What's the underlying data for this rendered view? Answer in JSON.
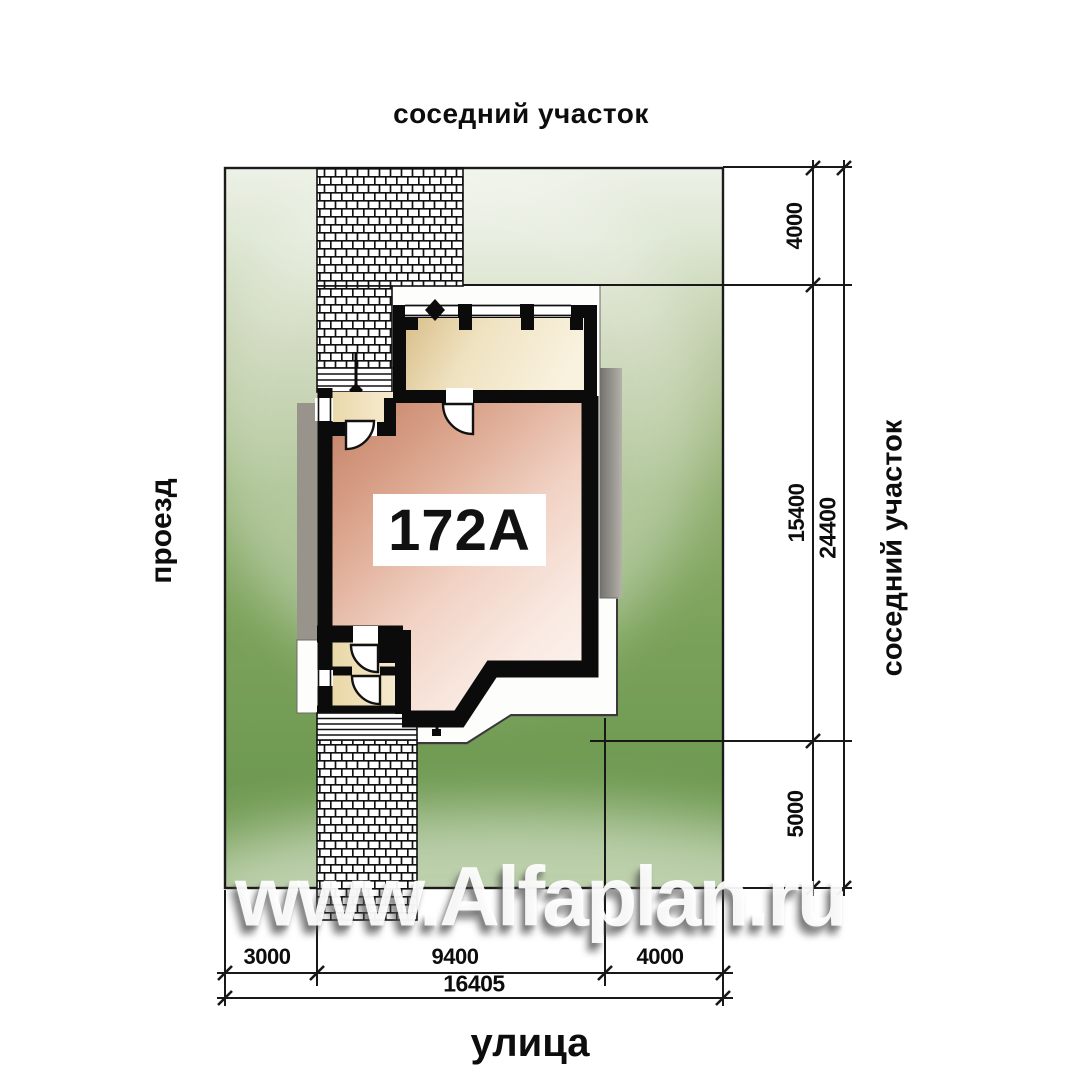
{
  "site_plan": {
    "labels": {
      "top_neighbor": "соседний участок",
      "right_neighbor": "соседний участок",
      "left_passage": "проезд",
      "bottom_street": "улица"
    },
    "house_number": "172A",
    "dimensions": {
      "right": [
        {
          "label": "4000"
        },
        {
          "label": "15400"
        },
        {
          "label": "5000"
        },
        {
          "label": "24400"
        }
      ],
      "bottom": [
        {
          "label": "3000"
        },
        {
          "label": "9400"
        },
        {
          "label": "4000"
        },
        {
          "label": "16405"
        }
      ]
    },
    "watermark": "www.Alfaplan.ru",
    "colors": {
      "plot_green": "#79a058",
      "plot_green_pale": "#e9efe2",
      "wall_black": "#0b0b0b",
      "house_pink": "#cf8f74",
      "room_cream": "#f0e2bd",
      "shadow_gray": "#95908a",
      "paper_white": "#ffffff"
    }
  }
}
